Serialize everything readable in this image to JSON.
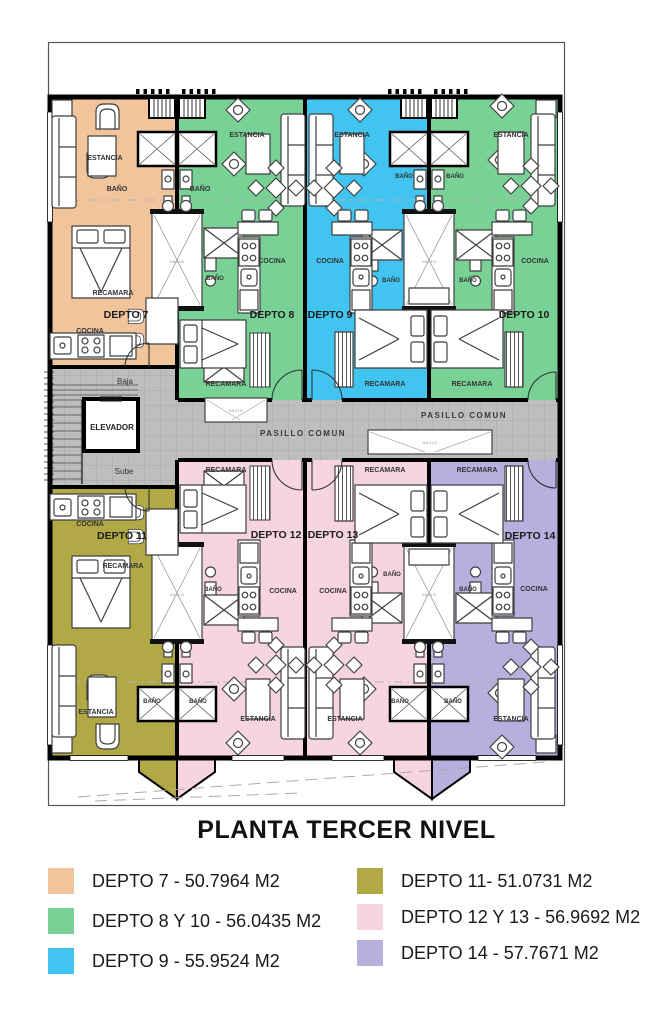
{
  "plan": {
    "title": "PLANTA TERCER NIVEL",
    "room_labels": {
      "estancia": "ESTANCIA",
      "bano": "BAÑO",
      "cocina": "COCINA",
      "recamara": "RECAMARA",
      "pasillo_comun": "PASILLO COMUN",
      "elevador": "ELEVADOR",
      "baja": "Baja",
      "sube": "Sube",
      "vacio": "VACIO"
    },
    "units": {
      "d7": {
        "label": "DEPTO 7",
        "color": "#F2C49C"
      },
      "d8": {
        "label": "DEPTO 8",
        "color": "#79D295"
      },
      "d9": {
        "label": "DEPTO 9",
        "color": "#41C4EF"
      },
      "d10": {
        "label": "DEPTO 10",
        "color": "#79D295"
      },
      "d11": {
        "label": "DEPTO 11",
        "color": "#B0A945"
      },
      "d12": {
        "label": "DEPTO 12",
        "color": "#F7D4E2"
      },
      "d13": {
        "label": "DEPTO 13",
        "color": "#F7D4E2"
      },
      "d14": {
        "label": "DEPTO 14",
        "color": "#B5B0DD"
      }
    },
    "corridor_color": "#BEBEBE"
  },
  "legend": {
    "items": [
      {
        "label": "DEPTO 7 - 50.7964 M2",
        "color": "#F2C49C"
      },
      {
        "label": "DEPTO 8 Y 10 - 56.0435 M2",
        "color": "#79D295"
      },
      {
        "label": "DEPTO 9 - 55.9524 M2",
        "color": "#41C4EF"
      },
      {
        "label": "DEPTO 11- 51.0731 M2",
        "color": "#B0A945"
      },
      {
        "label": "DEPTO 12 Y 13 - 56.9692 M2",
        "color": "#F7D4E2"
      },
      {
        "label": "DEPTO 14 - 57.7671 M2",
        "color": "#B5B0DD"
      }
    ]
  }
}
